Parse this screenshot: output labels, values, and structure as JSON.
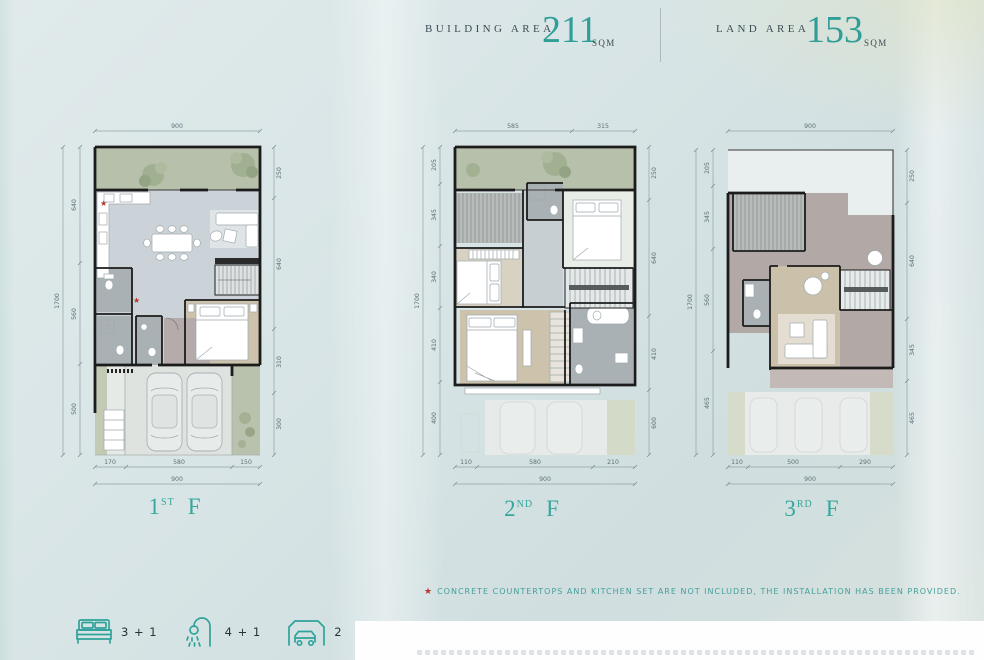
{
  "header": {
    "building": {
      "label": "BUILDING AREA",
      "value": "211",
      "unit": "SQM"
    },
    "land": {
      "label": "LAND AREA",
      "value": "153",
      "unit": "SQM"
    }
  },
  "floors": [
    {
      "label": {
        "number": "1",
        "ordinal": "ST",
        "letter": "F"
      },
      "dims": {
        "top": [
          "900"
        ],
        "bottom": [
          "170",
          "580",
          "150"
        ],
        "bottom_total": "900",
        "left": [
          "640",
          "560",
          "500"
        ],
        "left_total": "1700",
        "right": [
          "250",
          "640",
          "310",
          "300"
        ]
      }
    },
    {
      "label": {
        "number": "2",
        "ordinal": "ND",
        "letter": "F"
      },
      "dims": {
        "top": [
          "585",
          "315"
        ],
        "bottom": [
          "110",
          "580",
          "210"
        ],
        "bottom_total": "900",
        "left": [
          "205",
          "345",
          "340",
          "410",
          "400"
        ],
        "left_total": "1700",
        "right": [
          "250",
          "640",
          "410",
          "600"
        ]
      }
    },
    {
      "label": {
        "number": "3",
        "ordinal": "RD",
        "letter": "F"
      },
      "dims": {
        "top": [
          "900"
        ],
        "bottom": [
          "110",
          "500",
          "290"
        ],
        "bottom_total": "900",
        "left": [
          "205",
          "345",
          "560",
          "465"
        ],
        "left_total": "1700",
        "right": [
          "250",
          "640",
          "345",
          "465"
        ]
      }
    }
  ],
  "note": {
    "marker": "★",
    "text": "CONCRETE COUNTERTOPS AND KITCHEN SET ARE NOT INCLUDED, THE INSTALLATION HAS BEEN PROVIDED."
  },
  "legend": {
    "bedrooms": {
      "icon": "bed-icon",
      "value": "3 + 1"
    },
    "bathrooms": {
      "icon": "shower-icon",
      "value": "4 + 1"
    },
    "parking": {
      "icon": "carport-icon",
      "value": "2"
    }
  },
  "colors": {
    "accent_teal": "#2f9e96",
    "note_red": "#b5382e",
    "garden_green": "#b6c0aa",
    "wall_dark": "#1c1c1c",
    "floor_gray": "#ccd3d8",
    "wood": "#cdc3ad",
    "mauve": "#b2a8a6"
  }
}
